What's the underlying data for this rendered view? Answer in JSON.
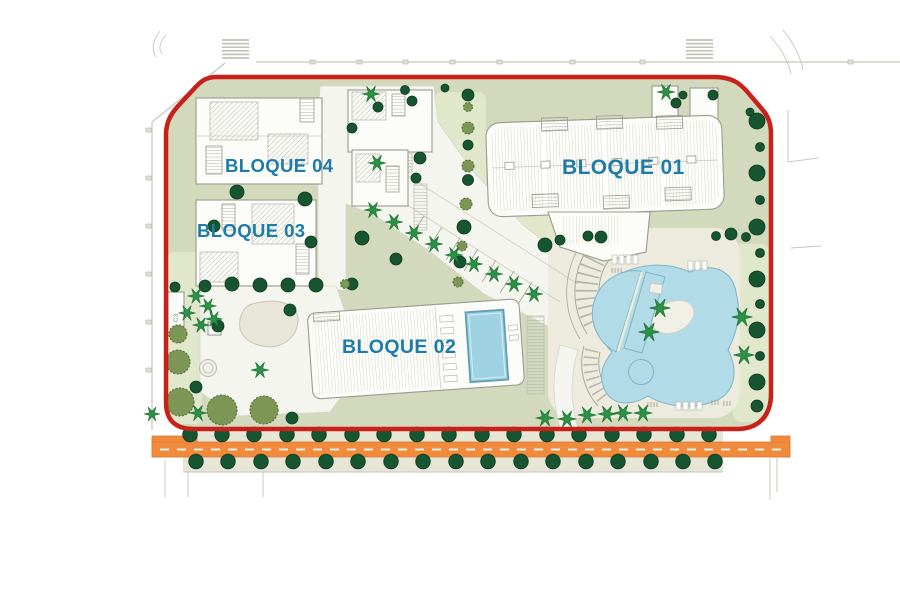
{
  "plan": {
    "labels": {
      "bloque01": "BLOQUE 01",
      "bloque02": "BLOQUE 02",
      "bloque03": "BLOQUE 03",
      "bloque04": "BLOQUE 04",
      "annotation": "C3"
    }
  },
  "colors": {
    "boundary": "#c9201a",
    "road": "#f08a3d",
    "road-edge": "#dd7a30",
    "sage": "#d3d9bd",
    "lawn": "#e0e7cb",
    "deck": "#ecebdd",
    "plaza": "#f5f5ef",
    "sand": "#e7e6d8",
    "sidewalk": "#e7e5d6",
    "building": "#fcfcf9",
    "building-stroke": "#9b9b91",
    "pool": "#b2dbe8",
    "pool-stroke": "#7fb4c8",
    "pool-deep": "#9fd2e2",
    "tree-dark": "#175430",
    "tree-olive": "#7c9655",
    "palm": "#2c9144",
    "label": "#1d7ca8",
    "context": "#c6c6bc"
  }
}
